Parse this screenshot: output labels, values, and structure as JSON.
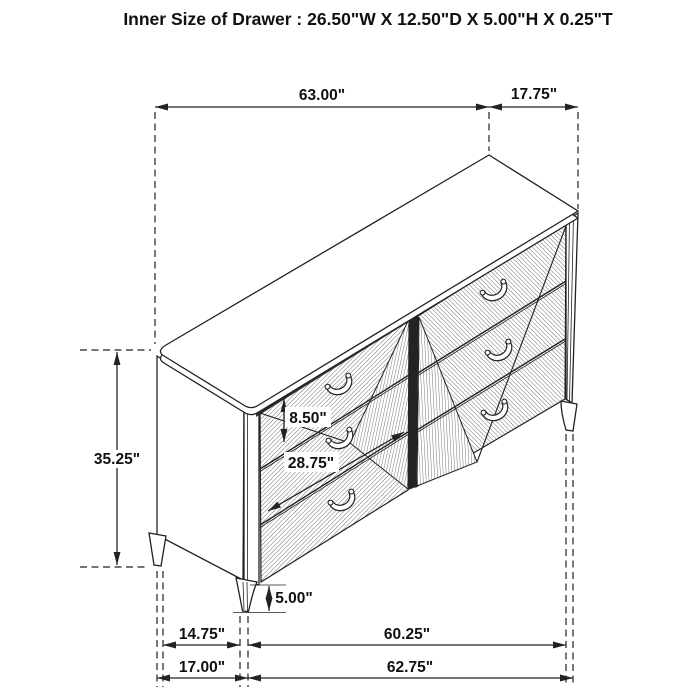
{
  "title": "Inner Size of Drawer : 26.50\"W X 12.50\"D X 5.00\"H X 0.25\"T",
  "dims": {
    "top_width": "63.00\"",
    "top_depth": "17.75\"",
    "overall_height": "35.25\"",
    "drawer_front_height": "8.50\"",
    "drawer_bank_width": "28.75\"",
    "leg_height": "5.00\"",
    "base_inner_depth": "14.75\"",
    "base_inner_width": "60.25\"",
    "base_outer_depth": "17.00\"",
    "base_outer_width": "62.75\""
  },
  "colors": {
    "line": "#222222",
    "hatch": "#3d3d3d",
    "dark_fill": "#383838",
    "stile_fill": "#232323",
    "background": "#ffffff"
  }
}
